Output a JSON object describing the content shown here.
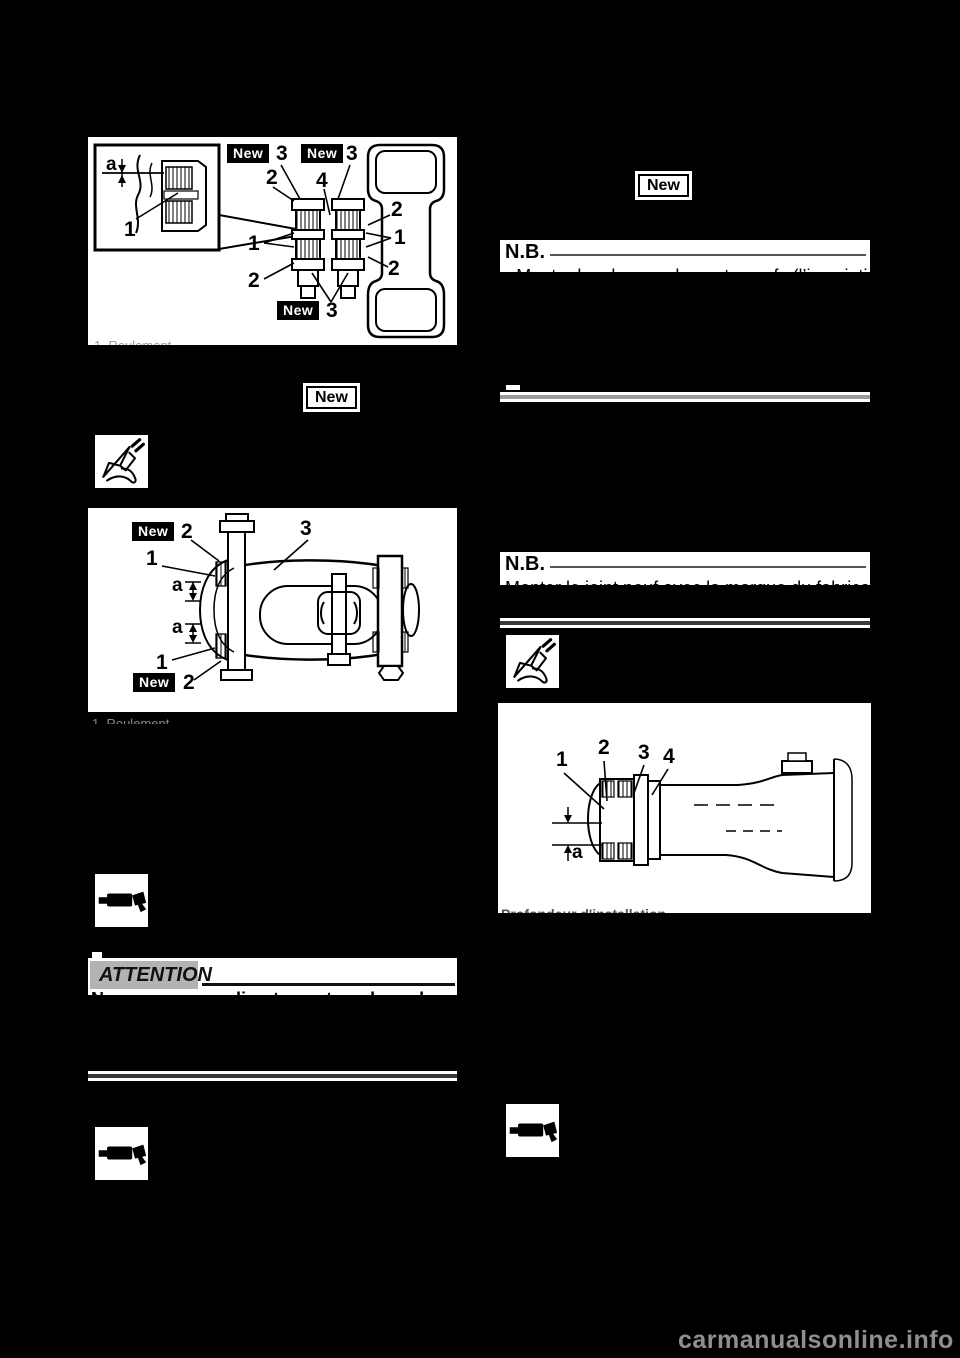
{
  "watermark": {
    "text": "carmanualsonline.info"
  },
  "colors": {
    "page_bg": "#000000",
    "figure_bg": "#ffffff",
    "attention_badge_bg": "#b3b3b3",
    "watermark_color": "#8f8f8f"
  },
  "icons": {
    "vernier_caliper": "measurement-caliper pictogram (line drawing)",
    "driver_tool": "bearing driver / installer tool pictogram (solid silhouette)"
  },
  "badges": {
    "new_left": "New",
    "new_right": "New"
  },
  "fig1": {
    "inset": {
      "dim_a": "a",
      "one": "1"
    },
    "callouts": {
      "new_a": "New",
      "three_a": "3",
      "new_b": "New",
      "three_b": "3",
      "two_top": "2",
      "four": "4",
      "two_right_top": "2",
      "one_right": "1",
      "two_right_bottom": "2",
      "one_left": "1",
      "two_left": "2",
      "new_c": "New",
      "three_c": "3"
    },
    "caption_fragment": "1. Roulement"
  },
  "fig2": {
    "callouts": {
      "new_top": "New",
      "two_top": "2",
      "one_top": "1",
      "a_top": "a",
      "a_bottom": "a",
      "one_bottom": "1",
      "new_bottom": "New",
      "two_bottom": "2",
      "three": "3"
    },
    "caption_fragment": "1. Roulement"
  },
  "fig3": {
    "callouts": {
      "one": "1",
      "two": "2",
      "three": "3",
      "four": "4",
      "dim_a": "a"
    },
    "caption_fragment": "Profondeur d'installation"
  },
  "nb1": {
    "label": "N.B.",
    "clipped_text": "• Monter les deux roulements neufs (l’inscription vers l’extérieur)."
  },
  "nb2": {
    "label": "N.B.",
    "clipped_text": "Monter le joint neuf avec la marque du fabricant vers l’extérieur."
  },
  "attention": {
    "label": "ATTENTION",
    "clipped_text": "Ne pas appuyer directement sur le roulement."
  }
}
